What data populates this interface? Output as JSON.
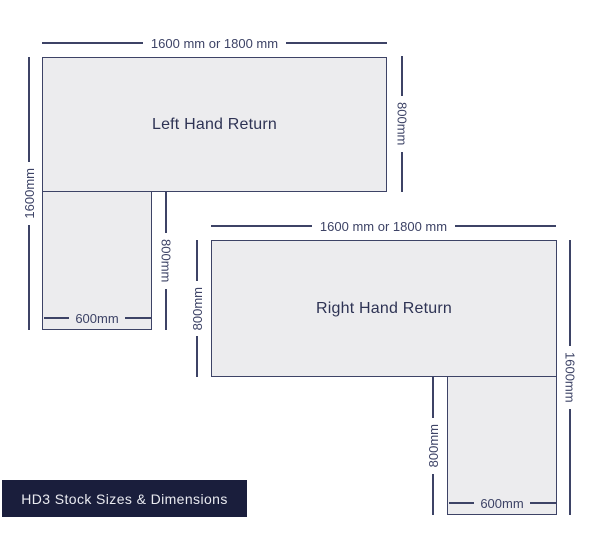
{
  "colors": {
    "line": "#3d4366",
    "desk_fill": "#ececee",
    "desk_text": "#2e3354",
    "badge_bg": "#1a1e3c",
    "badge_text": "#e9eaf0",
    "background": "#ffffff"
  },
  "diagrams": {
    "left_desk": {
      "label": "Left Hand Return",
      "top_dimension": "1600 mm or 1800 mm",
      "left_dimension": "1600mm",
      "right_dimension": "800mm",
      "return_depth_dimension": "800mm",
      "return_width_dimension": "600mm"
    },
    "right_desk": {
      "label": "Right Hand Return",
      "top_dimension": "1600 mm or 1800 mm",
      "left_dimension": "800mm",
      "right_dimension": "1600mm",
      "return_depth_dimension": "800mm",
      "return_width_dimension": "600mm"
    }
  },
  "badge": {
    "label": "HD3 Stock Sizes & Dimensions"
  }
}
